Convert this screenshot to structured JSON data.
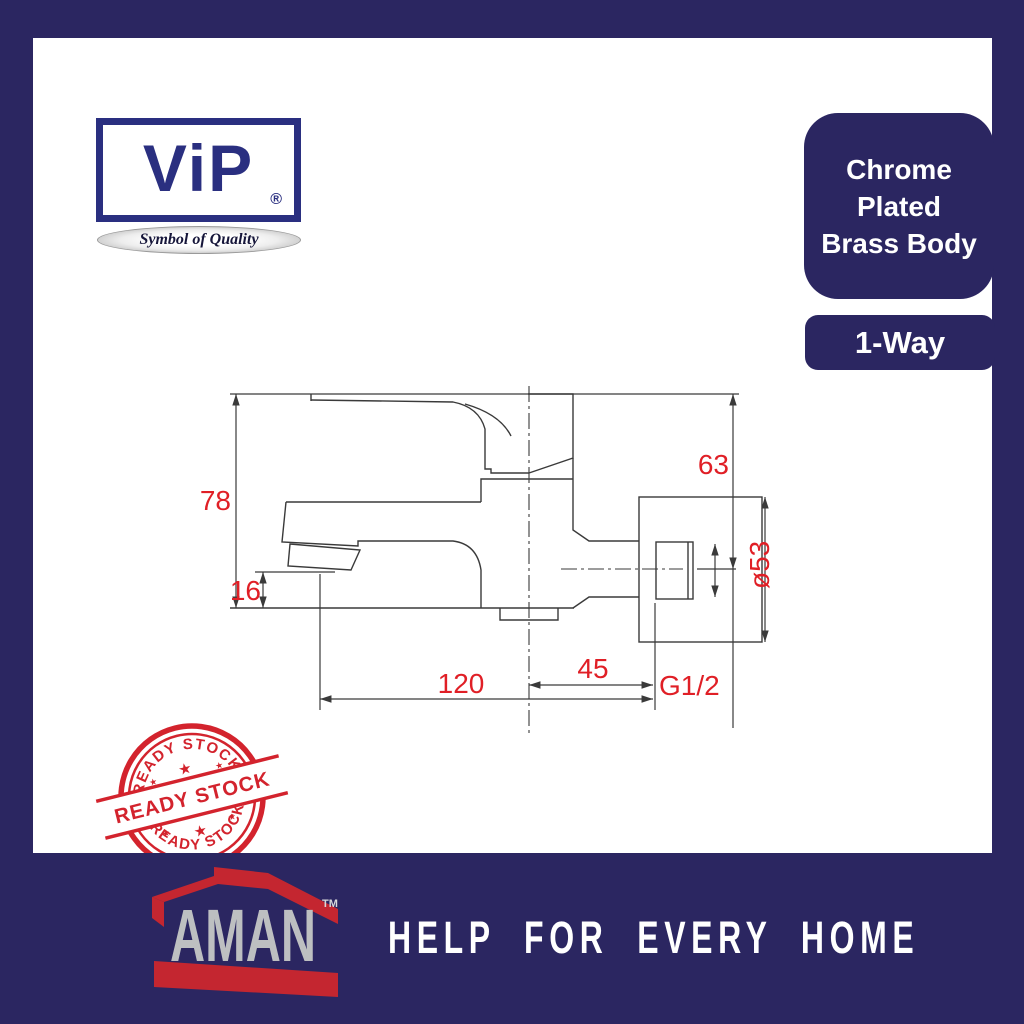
{
  "vip": {
    "wordmark": "ViP",
    "registered": "®",
    "tagline": "Symbol of Quality"
  },
  "badges": {
    "material_lines": [
      "Chrome",
      "Plated",
      "Brass Body"
    ],
    "way": "1-Way"
  },
  "diagram": {
    "dim_height_total": "78",
    "dim_spout_tip": "16",
    "dim_top_to_axis": "63",
    "dim_flange_diameter": "ø53",
    "dim_reach": "120",
    "dim_axis_to_wall": "45",
    "dim_thread": "G1/2"
  },
  "stamp": {
    "text": "READY STOCK",
    "star": "★"
  },
  "footer": {
    "brand": "AMAN",
    "trademark": "TM",
    "tagline": "HELP FOR EVERY HOME"
  },
  "colors": {
    "frame_navy": "#2b2661",
    "vip_blue": "#2a2f80",
    "dimension_red": "#e01f26",
    "stamp_red": "#d3232d",
    "aman_red": "#c42630",
    "aman_gray": "#bdbfc1",
    "white": "#ffffff"
  }
}
